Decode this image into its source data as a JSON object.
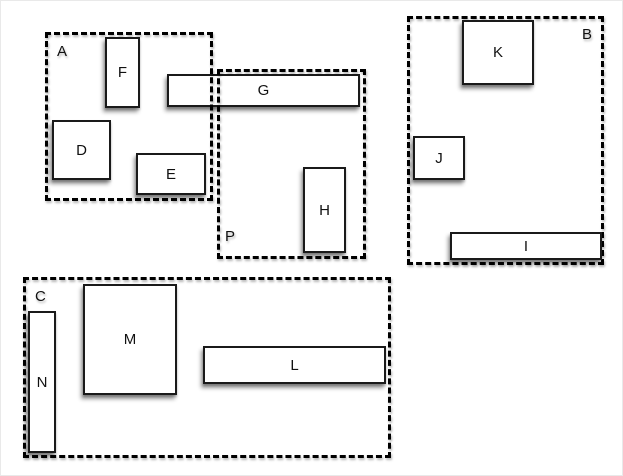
{
  "figure": {
    "type": "layout-diagram",
    "canvas": {
      "width": 623,
      "height": 476,
      "background": "#ffffff",
      "edge_border_color": "#e9e9e9"
    },
    "style": {
      "group_line_color": "#000000",
      "group_line_style": "dashed",
      "node_fill": "#ffffff",
      "node_border_color": "#1a1a1a",
      "label_color": "#111111",
      "shadow_color": "rgba(0,0,0,0.4)"
    },
    "groups": [
      {
        "id": "A",
        "label": "A",
        "x": 44,
        "y": 31,
        "w": 168,
        "h": 169,
        "label_pos": "top-left"
      },
      {
        "id": "P",
        "label": "P",
        "x": 216,
        "y": 68,
        "w": 149,
        "h": 190,
        "label_pos": "bottom-left"
      },
      {
        "id": "B",
        "label": "B",
        "x": 406,
        "y": 15,
        "w": 197,
        "h": 249,
        "label_pos": "top-right"
      },
      {
        "id": "C",
        "label": "C",
        "x": 22,
        "y": 276,
        "w": 368,
        "h": 181,
        "label_pos": "top-left"
      }
    ],
    "boxes": [
      {
        "id": "F",
        "label": "F",
        "x": 104,
        "y": 36,
        "w": 35,
        "h": 71,
        "under_dashes": false
      },
      {
        "id": "G",
        "label": "G",
        "x": 166,
        "y": 73,
        "w": 193,
        "h": 33,
        "under_dashes": true
      },
      {
        "id": "D",
        "label": "D",
        "x": 51,
        "y": 119,
        "w": 59,
        "h": 60,
        "under_dashes": false
      },
      {
        "id": "E",
        "label": "E",
        "x": 135,
        "y": 152,
        "w": 70,
        "h": 42,
        "under_dashes": false
      },
      {
        "id": "H",
        "label": "H",
        "x": 302,
        "y": 166,
        "w": 43,
        "h": 86,
        "under_dashes": false
      },
      {
        "id": "K",
        "label": "K",
        "x": 461,
        "y": 19,
        "w": 72,
        "h": 65,
        "under_dashes": false
      },
      {
        "id": "J",
        "label": "J",
        "x": 412,
        "y": 135,
        "w": 52,
        "h": 44,
        "under_dashes": false
      },
      {
        "id": "I",
        "label": "I",
        "x": 449,
        "y": 231,
        "w": 152,
        "h": 28,
        "under_dashes": false
      },
      {
        "id": "M",
        "label": "M",
        "x": 82,
        "y": 283,
        "w": 94,
        "h": 111,
        "under_dashes": false
      },
      {
        "id": "N",
        "label": "N",
        "x": 27,
        "y": 310,
        "w": 28,
        "h": 142,
        "under_dashes": false
      },
      {
        "id": "L",
        "label": "L",
        "x": 202,
        "y": 345,
        "w": 183,
        "h": 38,
        "under_dashes": false
      }
    ]
  }
}
